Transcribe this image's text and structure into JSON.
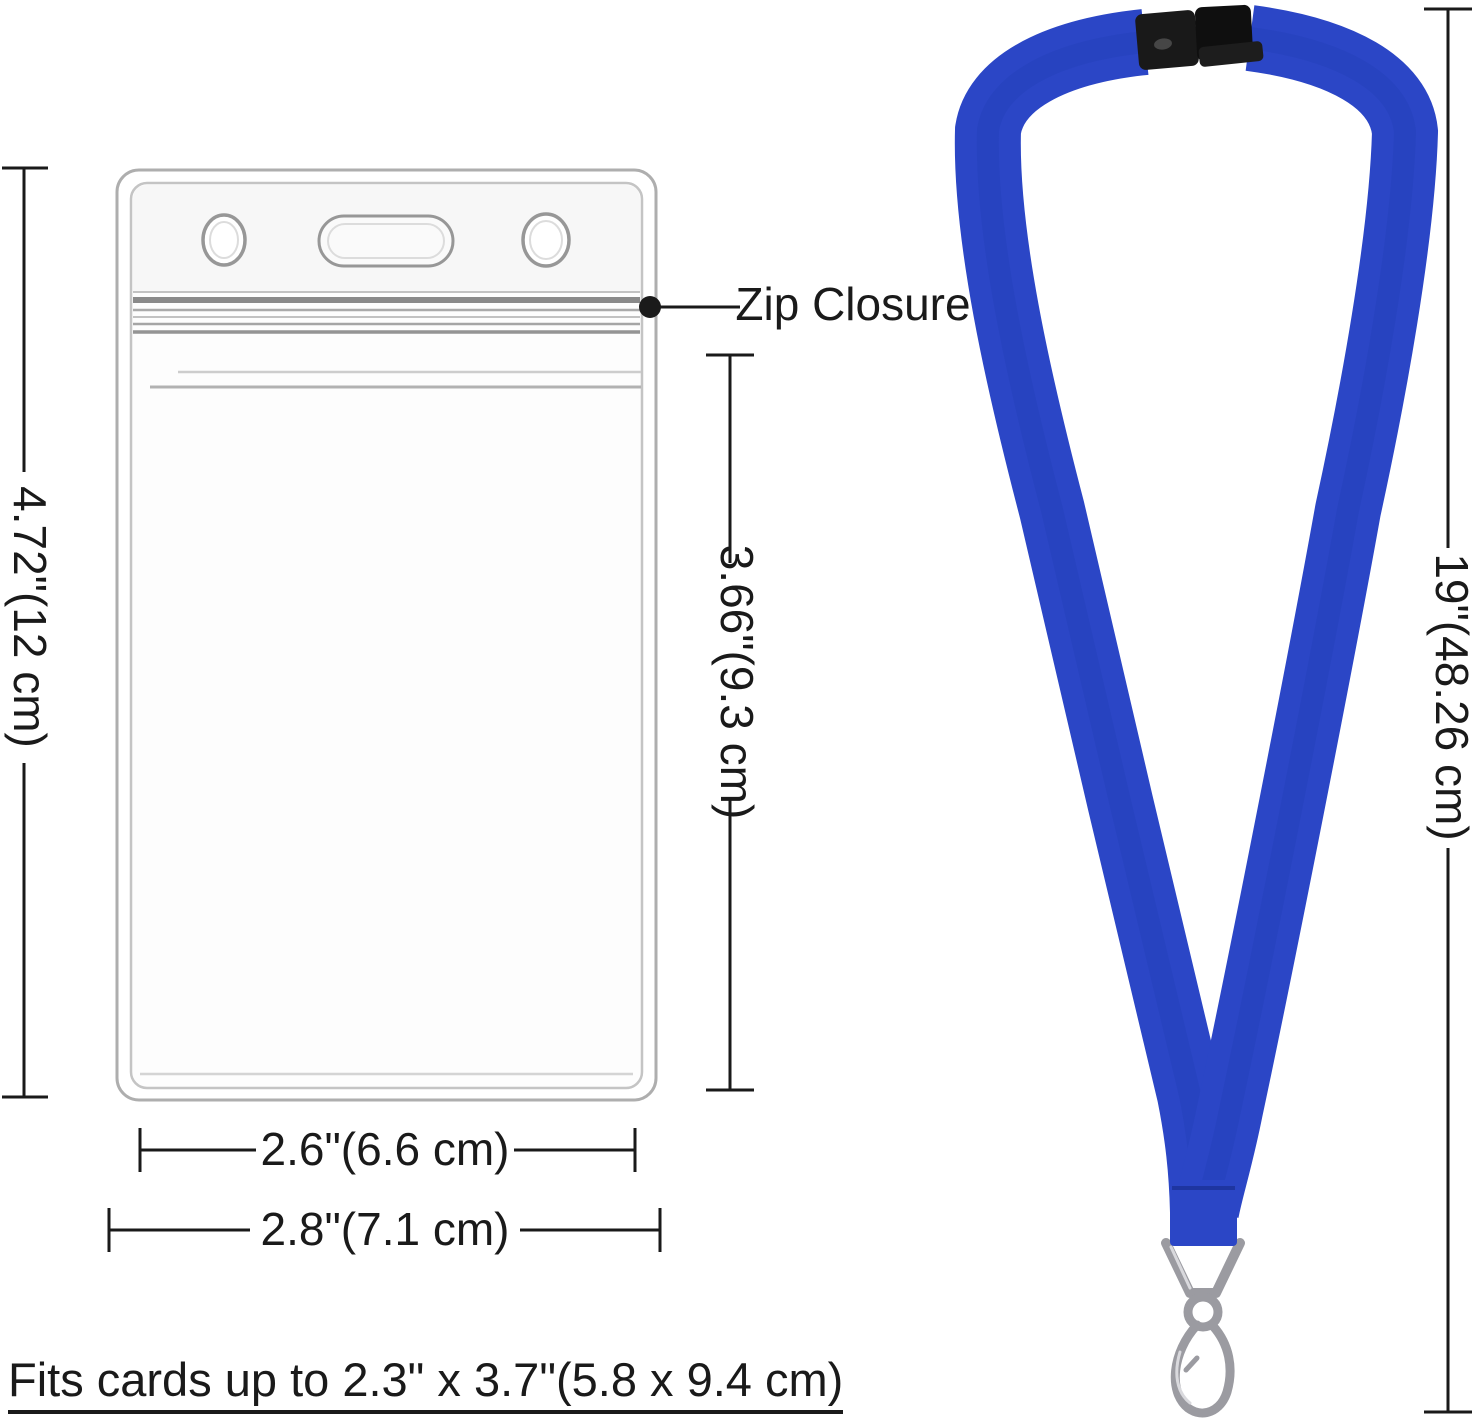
{
  "title": "ID badge holder and lanyard dimensions diagram",
  "callout": {
    "zip_closure": "Zip Closure"
  },
  "dimensions": {
    "holder_height": "4.72\"(12 cm)",
    "pocket_height": "3.66\"(9.3 cm)",
    "pocket_width": "2.6\"(6.6 cm)",
    "holder_width": "2.8\"(7.1 cm)",
    "lanyard_length": "19\"(48.26 cm)"
  },
  "note": {
    "fits_cards": "Fits cards up to 2.3\" x 3.7\"(5.8 x 9.4 cm)"
  },
  "colors": {
    "lanyard_blue": "#2b46c6",
    "buckle_black": "#1c1c1c",
    "metal_silver": "#9b9ba1",
    "dimension_line": "#1a1a1a",
    "holder_outline": "#aeaeae"
  }
}
